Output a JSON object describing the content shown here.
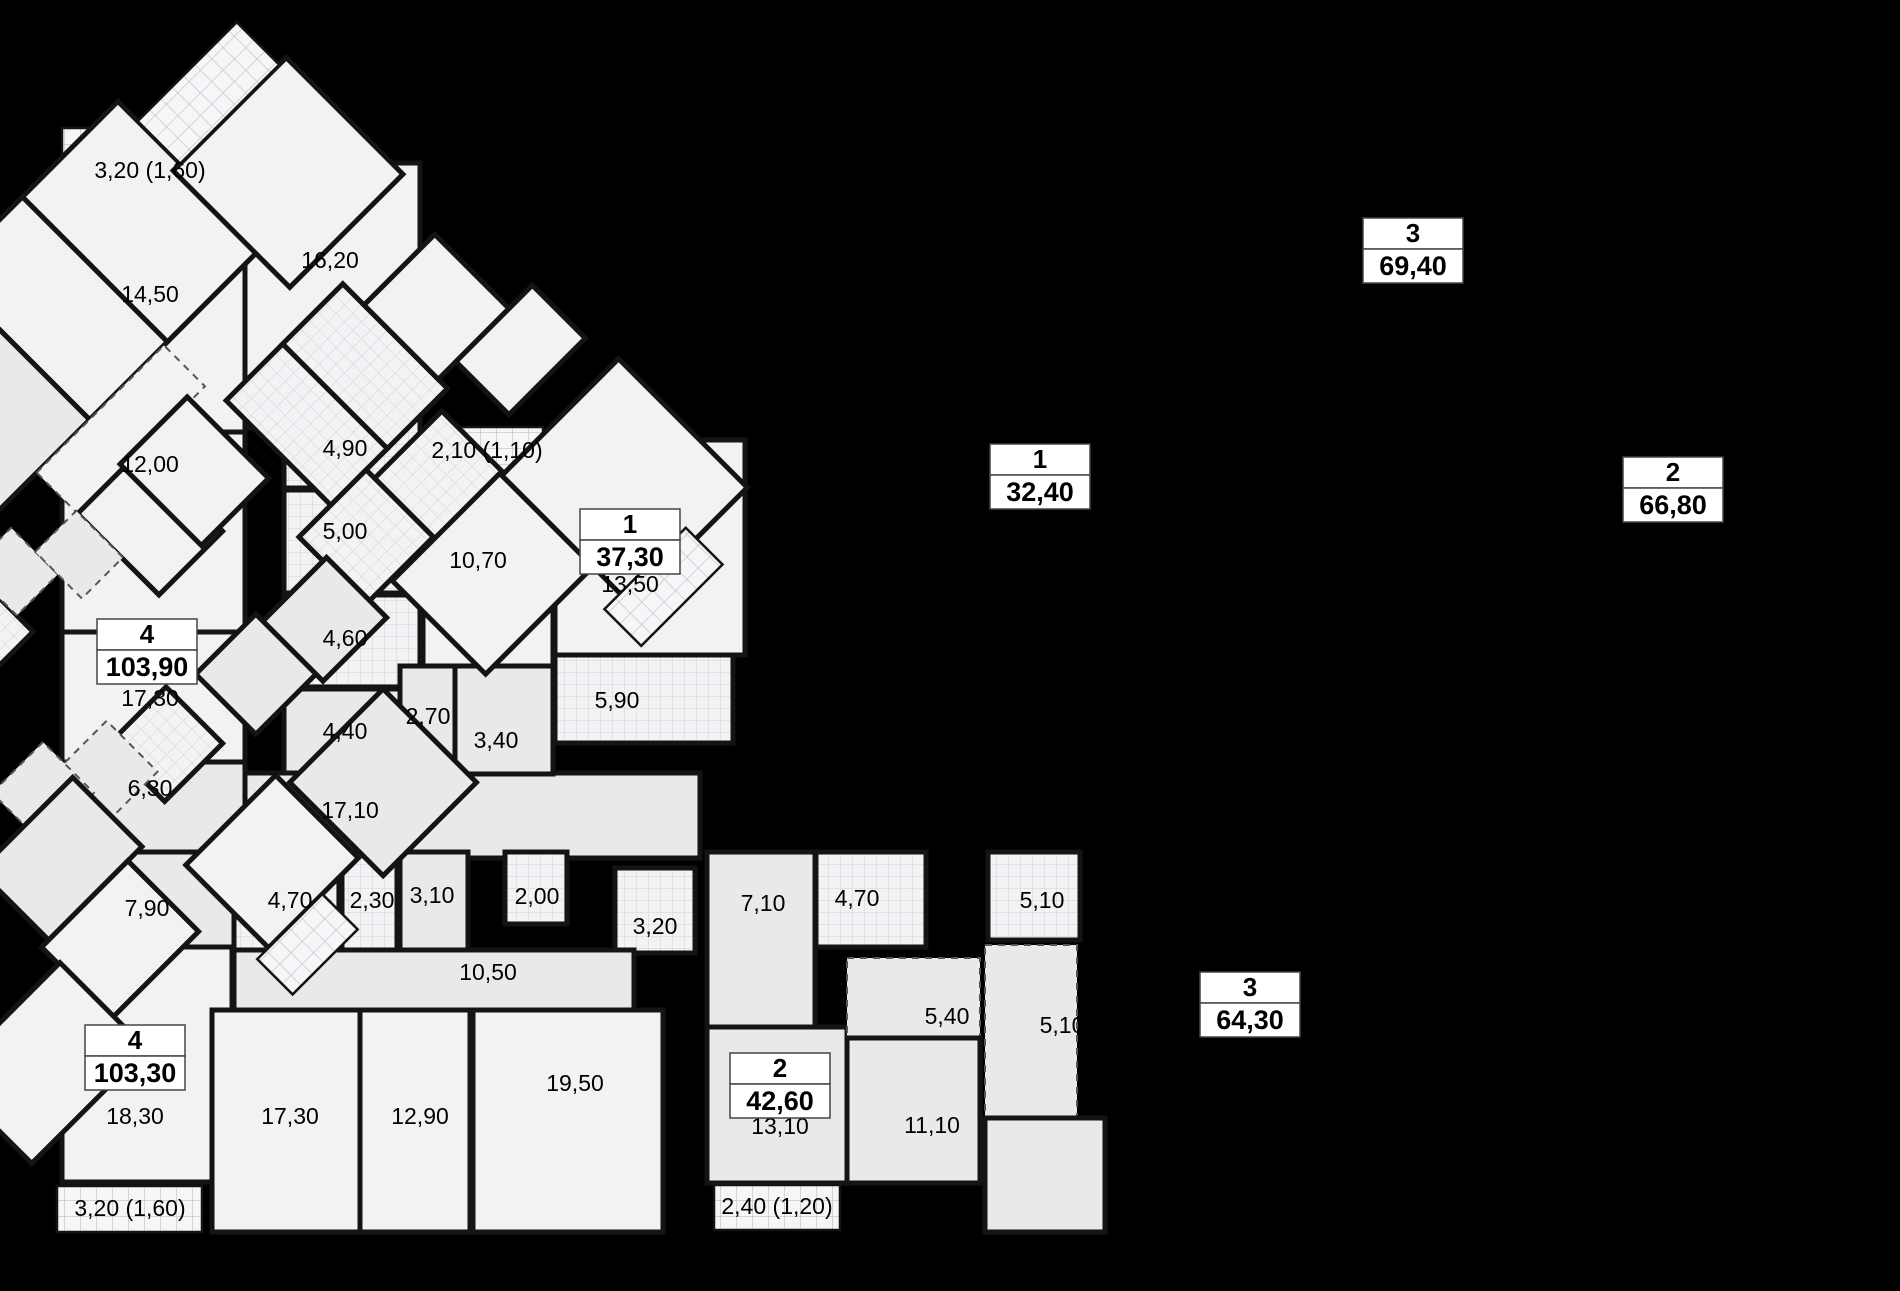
{
  "plan": {
    "canvas": {
      "w": 1900,
      "h": 1291,
      "background": "#000000"
    },
    "colors": {
      "room_light": "#f2f2f4",
      "room_gray": "#e9e9eb",
      "wall": "#141414",
      "tile_line": "#d2d2d8",
      "balcony_line": "#c0c0c6",
      "label_text": "#000000",
      "dash_line": "#555555",
      "box_border": "#444444",
      "box_fill": "#ffffff"
    },
    "wing": {
      "cx": 760,
      "cy": 800,
      "angle": -45
    },
    "ortho_rooms": [
      {
        "x": 62,
        "y": 128,
        "w": 178,
        "h": 57,
        "f": "k"
      },
      {
        "x": 62,
        "y": 185,
        "w": 183,
        "h": 247,
        "f": "a"
      },
      {
        "x": 245,
        "y": 163,
        "w": 175,
        "h": 265,
        "f": "a"
      },
      {
        "x": 62,
        "y": 432,
        "w": 183,
        "h": 200,
        "f": "a"
      },
      {
        "x": 62,
        "y": 632,
        "w": 183,
        "h": 130,
        "f": "a"
      },
      {
        "x": 62,
        "y": 762,
        "w": 183,
        "h": 96,
        "f": "b"
      },
      {
        "x": 284,
        "y": 388,
        "w": 136,
        "h": 100,
        "f": "t"
      },
      {
        "x": 284,
        "y": 490,
        "w": 136,
        "h": 103,
        "f": "t"
      },
      {
        "x": 284,
        "y": 595,
        "w": 136,
        "h": 92,
        "f": "t"
      },
      {
        "x": 284,
        "y": 689,
        "w": 136,
        "h": 84,
        "f": "b"
      },
      {
        "x": 245,
        "y": 773,
        "w": 455,
        "h": 85,
        "f": "b"
      },
      {
        "x": 430,
        "y": 427,
        "w": 113,
        "h": 48,
        "f": "k"
      },
      {
        "x": 423,
        "y": 477,
        "w": 130,
        "h": 190,
        "f": "a"
      },
      {
        "x": 400,
        "y": 666,
        "w": 55,
        "h": 108,
        "f": "b"
      },
      {
        "x": 455,
        "y": 666,
        "w": 98,
        "h": 108,
        "f": "b"
      },
      {
        "x": 555,
        "y": 440,
        "w": 190,
        "h": 215,
        "f": "a"
      },
      {
        "x": 555,
        "y": 655,
        "w": 178,
        "h": 88,
        "f": "t"
      },
      {
        "x": 62,
        "y": 852,
        "w": 172,
        "h": 95,
        "f": "b"
      },
      {
        "x": 62,
        "y": 947,
        "w": 170,
        "h": 235,
        "f": "a"
      },
      {
        "x": 57,
        "y": 1186,
        "w": 145,
        "h": 46,
        "f": "k"
      },
      {
        "x": 234,
        "y": 852,
        "w": 105,
        "h": 98,
        "f": "t"
      },
      {
        "x": 342,
        "y": 852,
        "w": 55,
        "h": 98,
        "f": "t"
      },
      {
        "x": 400,
        "y": 852,
        "w": 68,
        "h": 98,
        "f": "b"
      },
      {
        "x": 505,
        "y": 852,
        "w": 62,
        "h": 72,
        "f": "t"
      },
      {
        "x": 615,
        "y": 868,
        "w": 80,
        "h": 85,
        "f": "t"
      },
      {
        "x": 234,
        "y": 950,
        "w": 400,
        "h": 60,
        "f": "b"
      },
      {
        "x": 212,
        "y": 1010,
        "w": 148,
        "h": 222,
        "f": "a"
      },
      {
        "x": 360,
        "y": 1010,
        "w": 110,
        "h": 222,
        "f": "a"
      },
      {
        "x": 473,
        "y": 1010,
        "w": 190,
        "h": 222,
        "f": "a"
      },
      {
        "x": 707,
        "y": 852,
        "w": 108,
        "h": 175,
        "f": "b"
      },
      {
        "x": 816,
        "y": 852,
        "w": 110,
        "h": 95,
        "f": "t"
      },
      {
        "x": 707,
        "y": 1027,
        "w": 140,
        "h": 156,
        "f": "b"
      },
      {
        "x": 714,
        "y": 1185,
        "w": 126,
        "h": 45,
        "f": "k"
      },
      {
        "x": 847,
        "y": 958,
        "w": 133,
        "h": 80,
        "f": "b",
        "d": true
      },
      {
        "x": 847,
        "y": 1038,
        "w": 133,
        "h": 145,
        "f": "b"
      },
      {
        "x": 988,
        "y": 852,
        "w": 92,
        "h": 88,
        "f": "t"
      },
      {
        "x": 985,
        "y": 945,
        "w": 92,
        "h": 173,
        "f": "b",
        "d": true
      },
      {
        "x": 985,
        "y": 1118,
        "w": 120,
        "h": 114,
        "f": "b"
      }
    ],
    "wing_upper": [
      {
        "x": 360,
        "y": -205,
        "w": 195,
        "h": 57,
        "f": "k"
      },
      {
        "x": 270,
        "y": -148,
        "w": 285,
        "h": 205,
        "f": "b"
      },
      {
        "x": 555,
        "y": -148,
        "w": 110,
        "h": 205,
        "f": "a"
      },
      {
        "x": 665,
        "y": -148,
        "w": 135,
        "h": 205,
        "f": "a"
      },
      {
        "x": 790,
        "y": -60,
        "w": 160,
        "h": 165,
        "f": "a"
      },
      {
        "x": 800,
        "y": -120,
        "w": 140,
        "h": 60,
        "f": "k"
      },
      {
        "x": 480,
        "y": 57,
        "w": 180,
        "h": 58,
        "f": "a",
        "d": true
      },
      {
        "x": 480,
        "y": 115,
        "w": 90,
        "h": 115,
        "f": "a"
      },
      {
        "x": 545,
        "y": 110,
        "w": 95,
        "h": 115,
        "f": "a"
      },
      {
        "x": 665,
        "y": 140,
        "w": 80,
        "h": 148,
        "f": "t"
      },
      {
        "x": 745,
        "y": 140,
        "w": 85,
        "h": 148,
        "f": "t"
      },
      {
        "x": 830,
        "y": 170,
        "w": 100,
        "h": 105,
        "f": "a"
      },
      {
        "x": 855,
        "y": 275,
        "w": 108,
        "h": 75,
        "f": "a"
      },
      {
        "x": 715,
        "y": 300,
        "w": 95,
        "h": 95,
        "f": "t"
      },
      {
        "x": 620,
        "y": 288,
        "w": 95,
        "h": 95,
        "f": "t"
      },
      {
        "x": 265,
        "y": 95,
        "w": 100,
        "h": 72,
        "f": "t"
      },
      {
        "x": 365,
        "y": 78,
        "w": 58,
        "h": 66,
        "f": "b",
        "d": true
      },
      {
        "x": 423,
        "y": 112,
        "w": 58,
        "h": 66,
        "f": "b",
        "d": true
      }
    ],
    "wing_lower": [
      {
        "x": 535,
        "y": 322,
        "w": 90,
        "h": 85,
        "f": "b"
      },
      {
        "x": 450,
        "y": 312,
        "w": 85,
        "h": 85,
        "f": "b"
      },
      {
        "x": 338,
        "y": 300,
        "w": 82,
        "h": 80,
        "f": "t"
      },
      {
        "x": 282,
        "y": 282,
        "w": 72,
        "h": 72,
        "f": "b",
        "d": true
      },
      {
        "x": 222,
        "y": 252,
        "w": 72,
        "h": 72,
        "f": "b",
        "d": true
      },
      {
        "x": 158,
        "y": 298,
        "w": 132,
        "h": 98,
        "f": "b"
      },
      {
        "x": 148,
        "y": 396,
        "w": 122,
        "h": 100,
        "f": "a"
      },
      {
        "x": -12,
        "y": 420,
        "w": 162,
        "h": 122,
        "f": "a"
      },
      {
        "x": 308,
        "y": 440,
        "w": 127,
        "h": 117,
        "f": "a"
      },
      {
        "x": 292,
        "y": 557,
        "w": 92,
        "h": 50,
        "f": "k"
      },
      {
        "x": 440,
        "y": 455,
        "w": 132,
        "h": 132,
        "f": "b"
      },
      {
        "x": 655,
        "y": 385,
        "w": 152,
        "h": 132,
        "f": "a"
      },
      {
        "x": 807,
        "y": 388,
        "w": 165,
        "h": 182,
        "f": "a"
      },
      {
        "x": 785,
        "y": 555,
        "w": 115,
        "h": 52,
        "f": "k"
      }
    ],
    "room_labels": [
      {
        "t": "3,20 (1,60)",
        "x": 150,
        "y": 172
      },
      {
        "t": "14,50",
        "x": 150,
        "y": 296
      },
      {
        "t": "16,20",
        "x": 330,
        "y": 262
      },
      {
        "t": "12,00",
        "x": 150,
        "y": 466
      },
      {
        "t": "4,90",
        "x": 345,
        "y": 450
      },
      {
        "t": "5,00",
        "x": 345,
        "y": 533
      },
      {
        "t": "4,60",
        "x": 345,
        "y": 640
      },
      {
        "t": "4,40",
        "x": 345,
        "y": 733
      },
      {
        "t": "17,30",
        "x": 150,
        "y": 700
      },
      {
        "t": "6,30",
        "x": 150,
        "y": 790
      },
      {
        "t": "17,10",
        "x": 350,
        "y": 812
      },
      {
        "t": "2,10 (1,10)",
        "x": 487,
        "y": 452
      },
      {
        "t": "10,70",
        "x": 478,
        "y": 562
      },
      {
        "t": "2,70",
        "x": 428,
        "y": 718
      },
      {
        "t": "3,40",
        "x": 496,
        "y": 742
      },
      {
        "t": "13,50",
        "x": 630,
        "y": 586
      },
      {
        "t": "5,90",
        "x": 617,
        "y": 702
      },
      {
        "t": "7,90",
        "x": 147,
        "y": 910
      },
      {
        "t": "4,70",
        "x": 290,
        "y": 902
      },
      {
        "t": "2,30",
        "x": 372,
        "y": 902
      },
      {
        "t": "3,10",
        "x": 432,
        "y": 897
      },
      {
        "t": "2,00",
        "x": 537,
        "y": 898
      },
      {
        "t": "3,20",
        "x": 655,
        "y": 928
      },
      {
        "t": "10,50",
        "x": 488,
        "y": 974
      },
      {
        "t": "18,30",
        "x": 135,
        "y": 1118
      },
      {
        "t": "3,20 (1,60)",
        "x": 130,
        "y": 1210
      },
      {
        "t": "17,30",
        "x": 290,
        "y": 1118
      },
      {
        "t": "12,90",
        "x": 420,
        "y": 1118
      },
      {
        "t": "19,50",
        "x": 575,
        "y": 1085
      },
      {
        "t": "7,10",
        "x": 763,
        "y": 905
      },
      {
        "t": "4,70",
        "x": 857,
        "y": 900
      },
      {
        "t": "13,10",
        "x": 780,
        "y": 1128
      },
      {
        "t": "2,40 (1,20)",
        "x": 777,
        "y": 1208
      },
      {
        "t": "5,40",
        "x": 947,
        "y": 1018
      },
      {
        "t": "11,10",
        "x": 932,
        "y": 1127
      },
      {
        "t": "5,10",
        "x": 1042,
        "y": 902
      },
      {
        "t": "5,10",
        "x": 1062,
        "y": 1027
      },
      {
        "t": "14,50",
        "x": 1142,
        "y": 1098
      },
      {
        "t": "2,40",
        "t2": "(0,70)",
        "x": 953,
        "y": 316
      },
      {
        "t": "15,60",
        "x": 1022,
        "y": 431
      },
      {
        "t": "6,20",
        "x": 999,
        "y": 575
      },
      {
        "t": "4,80",
        "x": 1070,
        "y": 671
      },
      {
        "t": "2,70",
        "x": 1117,
        "y": 593
      },
      {
        "t": "2,40",
        "x": 1175,
        "y": 588
      },
      {
        "t": "9,50",
        "x": 1121,
        "y": 341
      },
      {
        "t": "14,30",
        "x": 1268,
        "y": 298
      },
      {
        "t": "2,50",
        "t2": "(1,30)",
        "x": 1322,
        "y": 118
      },
      {
        "t": "17,10",
        "x": 1390,
        "y": 203
      },
      {
        "t": "6,40",
        "x": 1197,
        "y": 443
      },
      {
        "t": "5,40",
        "x": 1285,
        "y": 478
      },
      {
        "t": "3,10",
        "x": 1245,
        "y": 547
      },
      {
        "t": "3,90",
        "x": 1462,
        "y": 398
      },
      {
        "t": "5,40",
        "x": 1400,
        "y": 460
      },
      {
        "t": "4,80",
        "x": 1462,
        "y": 556
      },
      {
        "t": "3,00",
        "x": 1546,
        "y": 358
      },
      {
        "t": "2,80",
        "x": 1601,
        "y": 366
      },
      {
        "t": "3,50",
        "x": 1547,
        "y": 510
      },
      {
        "t": "5,40",
        "x": 1415,
        "y": 657
      },
      {
        "t": "3,60",
        "x": 1362,
        "y": 699
      },
      {
        "t": "4,00",
        "x": 1268,
        "y": 769
      },
      {
        "t": "2,70",
        "x": 1214,
        "y": 797
      },
      {
        "t": "2,10",
        "x": 1151,
        "y": 821
      },
      {
        "t": "6,60",
        "x": 1151,
        "y": 898
      },
      {
        "t": "11,80",
        "x": 1220,
        "y": 966
      },
      {
        "t": "11,20",
        "x": 1374,
        "y": 889
      },
      {
        "t": "2,40",
        "t2": "(1,20)",
        "x": 1397,
        "y": 956
      },
      {
        "t": "14,60",
        "x": 1487,
        "y": 811
      },
      {
        "t": "14,00",
        "x": 1592,
        "y": 601
      },
      {
        "t": "16,80",
        "x": 1702,
        "y": 533
      },
      {
        "t": "2,60",
        "t2": "(1,30)",
        "x": 1760,
        "y": 574
      }
    ],
    "apartments": [
      {
        "rooms": "4",
        "area": "103,90",
        "x": 147,
        "y": 652
      },
      {
        "rooms": "1",
        "area": "37,30",
        "x": 630,
        "y": 542
      },
      {
        "rooms": "4",
        "area": "103,30",
        "x": 135,
        "y": 1058
      },
      {
        "rooms": "2",
        "area": "42,60",
        "x": 780,
        "y": 1086
      },
      {
        "rooms": "1",
        "area": "32,40",
        "x": 1040,
        "y": 477
      },
      {
        "rooms": "3",
        "area": "69,40",
        "x": 1413,
        "y": 251
      },
      {
        "rooms": "2",
        "area": "66,80",
        "x": 1673,
        "y": 490
      },
      {
        "rooms": "3",
        "area": "64,30",
        "x": 1250,
        "y": 1005
      }
    ]
  }
}
